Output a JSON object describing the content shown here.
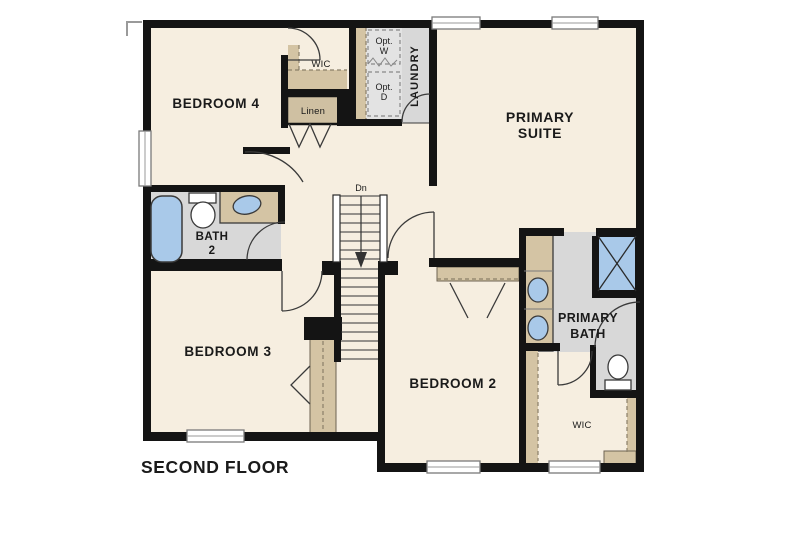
{
  "floor_title": "SECOND FLOOR",
  "rooms": {
    "bedroom4": "BEDROOM 4",
    "bedroom3": "BEDROOM 3",
    "bedroom2": "BEDROOM 2",
    "primary_suite": [
      "PRIMARY",
      "SUITE"
    ],
    "primary_bath": [
      "PRIMARY",
      "BATH"
    ],
    "bath2": [
      "BATH",
      "2"
    ],
    "wic_bedroom4": "WIC",
    "wic_primary": "WIC",
    "linen": "Linen",
    "laundry": "LAUNDRY",
    "opt_washer": [
      "Opt.",
      "W"
    ],
    "opt_dryer": [
      "Opt.",
      "D"
    ],
    "stairs_down": "Dn"
  },
  "colors": {
    "floor_cream": "#f6eee0",
    "tile_gray": "#d8d8d8",
    "opt_area_gray": "#e3e3e3",
    "cabinet_tan": "#d4c4a4",
    "fixture_blue": "#a9c9e9",
    "wall_black": "#141414",
    "background": "#ffffff"
  }
}
